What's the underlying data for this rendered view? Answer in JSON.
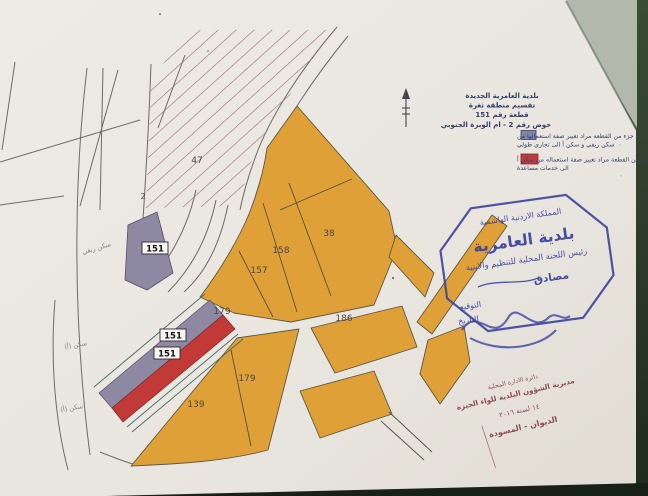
{
  "document_type": "cadastral zoning map sheet (photographed paper)",
  "colors": {
    "paper": "#ebe8e2",
    "paper_dark": "#e2ded6",
    "table_green": "#2e4231",
    "corner_gray": "#b2b8ac",
    "parcel_orange": "#dfa137",
    "zone_gray": "#8d89a3",
    "zone_red": "#c23a38",
    "hatch": "#96687c",
    "ink_blue": "#3f44a0",
    "ink_navy": "#333f63",
    "ink_maroon": "#8a4450",
    "survey_line": "#6f6a62"
  },
  "title_block": {
    "line1": "بلدية العامرية الجديدة",
    "line2": "تقسيم منطقة ثغرة",
    "line3": "قطعة رقم 151",
    "line4": "حوض رقم 2 - ام الوبرة الجنوبي"
  },
  "legend": {
    "items": [
      {
        "color": "#8284a6",
        "line1": "جزء من القطعة مراد تغيير صفة استعمالها من",
        "line2": "سكن ريفي و سكن أ الى تجاري طولي"
      },
      {
        "color": "#bf3a40",
        "line1": "جزء من القطعة مراد تغيير صفة استعماله من سكن أ",
        "line2": "الى خدمات مساعدة"
      }
    ]
  },
  "map": {
    "parcel_labels": {
      "p47": "47",
      "p2": "2",
      "p151a": "151",
      "p151b": "151",
      "p151c": "151",
      "p157": "157",
      "p158": "158",
      "p38": "38",
      "p179a": "179",
      "p179b": "179",
      "p139": "139",
      "p186": "186"
    },
    "annotations": {
      "a1": "سكن ريفي",
      "a2": "سكن (أ)",
      "a3": "سكن (أ)"
    }
  },
  "octagon_stamp": {
    "kingdom": "المملكة الاردنية الهاشمية",
    "municipality": "بلدية العامرية",
    "committee": "رئيس اللجنة المحلية للتنظيم والابنية",
    "approved": "مصادق",
    "signature_label": "التوقيع",
    "date_label": "التاريخ"
  },
  "office_stamp": {
    "line1": "دائرة الادارة المحلية",
    "line2": "مديرية الشؤون البلدية للواء الجيزة",
    "line3": "١٤ لسنة ٢٠١٦",
    "line4": "الديوان - المسودة"
  }
}
